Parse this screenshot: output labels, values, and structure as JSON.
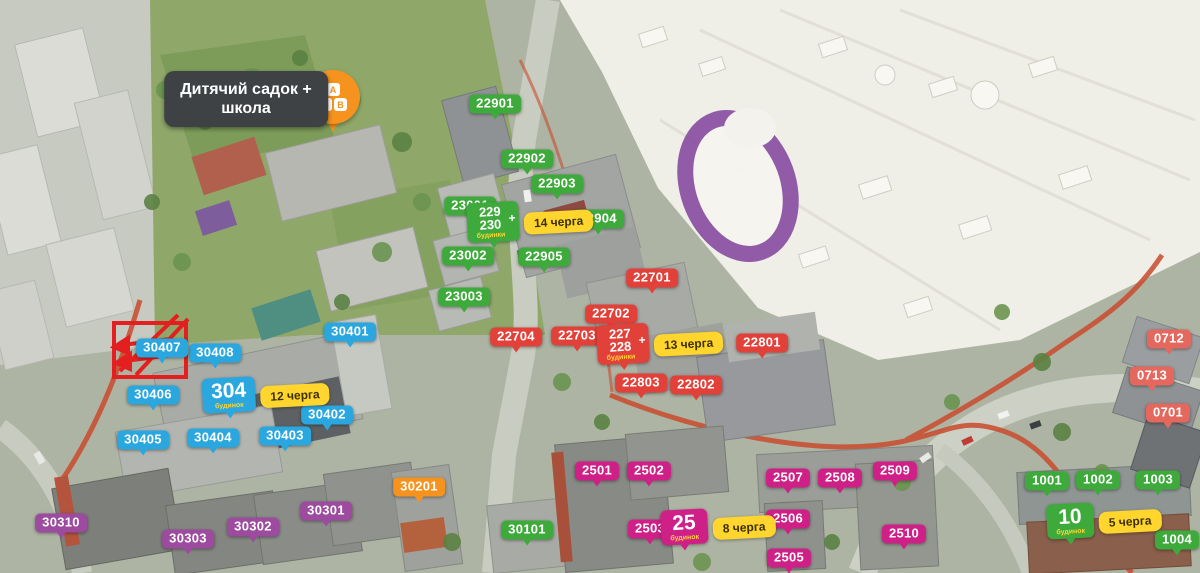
{
  "palette": {
    "green": "#3faa3c",
    "red": "#e2413a",
    "coral": "#e4685e",
    "blue": "#2ba7df",
    "purple": "#9c4b9e",
    "magenta": "#cf2088",
    "orange": "#f6921e",
    "yellow": "#ffd52e",
    "yellow_text": "#3c3000",
    "subtext_yellow": "#ffd52e",
    "dark_label_bg": "#3e4245",
    "label_text": "#ffffff",
    "cross_red": "#e31f1f",
    "pin_orange": "#f6921e",
    "mall_ring_purple": "#8a4fa3"
  },
  "school_callout": {
    "line1": "Дитячий садок +",
    "line2": "школа",
    "x": 246,
    "y": 99,
    "pin": {
      "x": 333,
      "y": 97,
      "blocks": [
        "А",
        "Б",
        "В"
      ]
    }
  },
  "building_labels": [
    {
      "id": "22901",
      "color": "green",
      "x": 495,
      "y": 104
    },
    {
      "id": "22902",
      "color": "green",
      "x": 527,
      "y": 159
    },
    {
      "id": "22903",
      "color": "green",
      "x": 557,
      "y": 184
    },
    {
      "id": "23001",
      "color": "green",
      "x": 470,
      "y": 206
    },
    {
      "id": "23002",
      "color": "green",
      "x": 468,
      "y": 256
    },
    {
      "id": "23003",
      "color": "green",
      "x": 464,
      "y": 297
    },
    {
      "id": "22904",
      "color": "green",
      "x": 598,
      "y": 219
    },
    {
      "id": "22905",
      "color": "green",
      "x": 544,
      "y": 257
    },
    {
      "id": "22701",
      "color": "red",
      "x": 652,
      "y": 278
    },
    {
      "id": "22702",
      "color": "red",
      "x": 611,
      "y": 314
    },
    {
      "id": "22703",
      "color": "red",
      "x": 577,
      "y": 336
    },
    {
      "id": "22704",
      "color": "red",
      "x": 516,
      "y": 337
    },
    {
      "id": "22801",
      "color": "red",
      "x": 762,
      "y": 343
    },
    {
      "id": "22803",
      "color": "red",
      "x": 641,
      "y": 383
    },
    {
      "id": "22802",
      "color": "red",
      "x": 696,
      "y": 385
    },
    {
      "id": "30401",
      "color": "blue",
      "x": 350,
      "y": 332
    },
    {
      "id": "30408",
      "color": "blue",
      "x": 215,
      "y": 353
    },
    {
      "id": "30407",
      "color": "blue",
      "x": 162,
      "y": 348
    },
    {
      "id": "30406",
      "color": "blue",
      "x": 153,
      "y": 395
    },
    {
      "id": "30402",
      "color": "blue",
      "x": 327,
      "y": 415
    },
    {
      "id": "30403",
      "color": "blue",
      "x": 285,
      "y": 436
    },
    {
      "id": "30404",
      "color": "blue",
      "x": 213,
      "y": 438
    },
    {
      "id": "30405",
      "color": "blue",
      "x": 143,
      "y": 440
    },
    {
      "id": "30310",
      "color": "purple",
      "x": 61,
      "y": 523
    },
    {
      "id": "30303",
      "color": "purple",
      "x": 188,
      "y": 539
    },
    {
      "id": "30302",
      "color": "purple",
      "x": 253,
      "y": 527
    },
    {
      "id": "30301",
      "color": "purple",
      "x": 326,
      "y": 511
    },
    {
      "id": "30201",
      "color": "orange",
      "x": 419,
      "y": 487
    },
    {
      "id": "30101",
      "color": "green",
      "x": 527,
      "y": 530
    },
    {
      "id": "2501",
      "color": "magenta",
      "x": 597,
      "y": 471
    },
    {
      "id": "2502",
      "color": "magenta",
      "x": 649,
      "y": 471
    },
    {
      "id": "2503",
      "color": "magenta",
      "x": 650,
      "y": 529
    },
    {
      "id": "2507",
      "color": "magenta",
      "x": 788,
      "y": 478
    },
    {
      "id": "2508",
      "color": "magenta",
      "x": 840,
      "y": 478
    },
    {
      "id": "2509",
      "color": "magenta",
      "x": 895,
      "y": 471
    },
    {
      "id": "2506",
      "color": "magenta",
      "x": 788,
      "y": 519
    },
    {
      "id": "2505",
      "color": "magenta",
      "x": 789,
      "y": 558
    },
    {
      "id": "2510",
      "color": "magenta",
      "x": 904,
      "y": 534
    },
    {
      "id": "0712",
      "color": "coral",
      "x": 1169,
      "y": 339
    },
    {
      "id": "0713",
      "color": "coral",
      "x": 1152,
      "y": 376
    },
    {
      "id": "0701",
      "color": "coral",
      "x": 1168,
      "y": 413
    },
    {
      "id": "1001",
      "color": "green",
      "x": 1047,
      "y": 481
    },
    {
      "id": "1002",
      "color": "green",
      "x": 1098,
      "y": 480
    },
    {
      "id": "1003",
      "color": "green",
      "x": 1158,
      "y": 480
    },
    {
      "id": "1004",
      "color": "green",
      "x": 1177,
      "y": 540
    }
  ],
  "phase_callouts": [
    {
      "lines": [
        "229",
        "230"
      ],
      "plus": "+",
      "subtext": "будинки",
      "color": "green",
      "phase": "14 черга",
      "x": 530,
      "y": 222
    },
    {
      "lines": [
        "227",
        "228"
      ],
      "plus": "+",
      "subtext": "будинки",
      "color": "red",
      "phase": "13 черга",
      "x": 660,
      "y": 344
    },
    {
      "lines": [
        "304"
      ],
      "plus": "",
      "subtext": "будинок",
      "color": "blue",
      "phase": "12 черга",
      "x": 266,
      "y": 395
    },
    {
      "lines": [
        "25"
      ],
      "plus": "",
      "subtext": "будинок",
      "color": "magenta",
      "phase": "8 черга",
      "x": 718,
      "y": 527
    },
    {
      "lines": [
        "10"
      ],
      "plus": "",
      "subtext": "будинок",
      "color": "green",
      "phase": "5 черга",
      "x": 1104,
      "y": 521
    }
  ],
  "crossed_area": {
    "x": 112,
    "y": 321,
    "width": 76,
    "height": 58
  }
}
